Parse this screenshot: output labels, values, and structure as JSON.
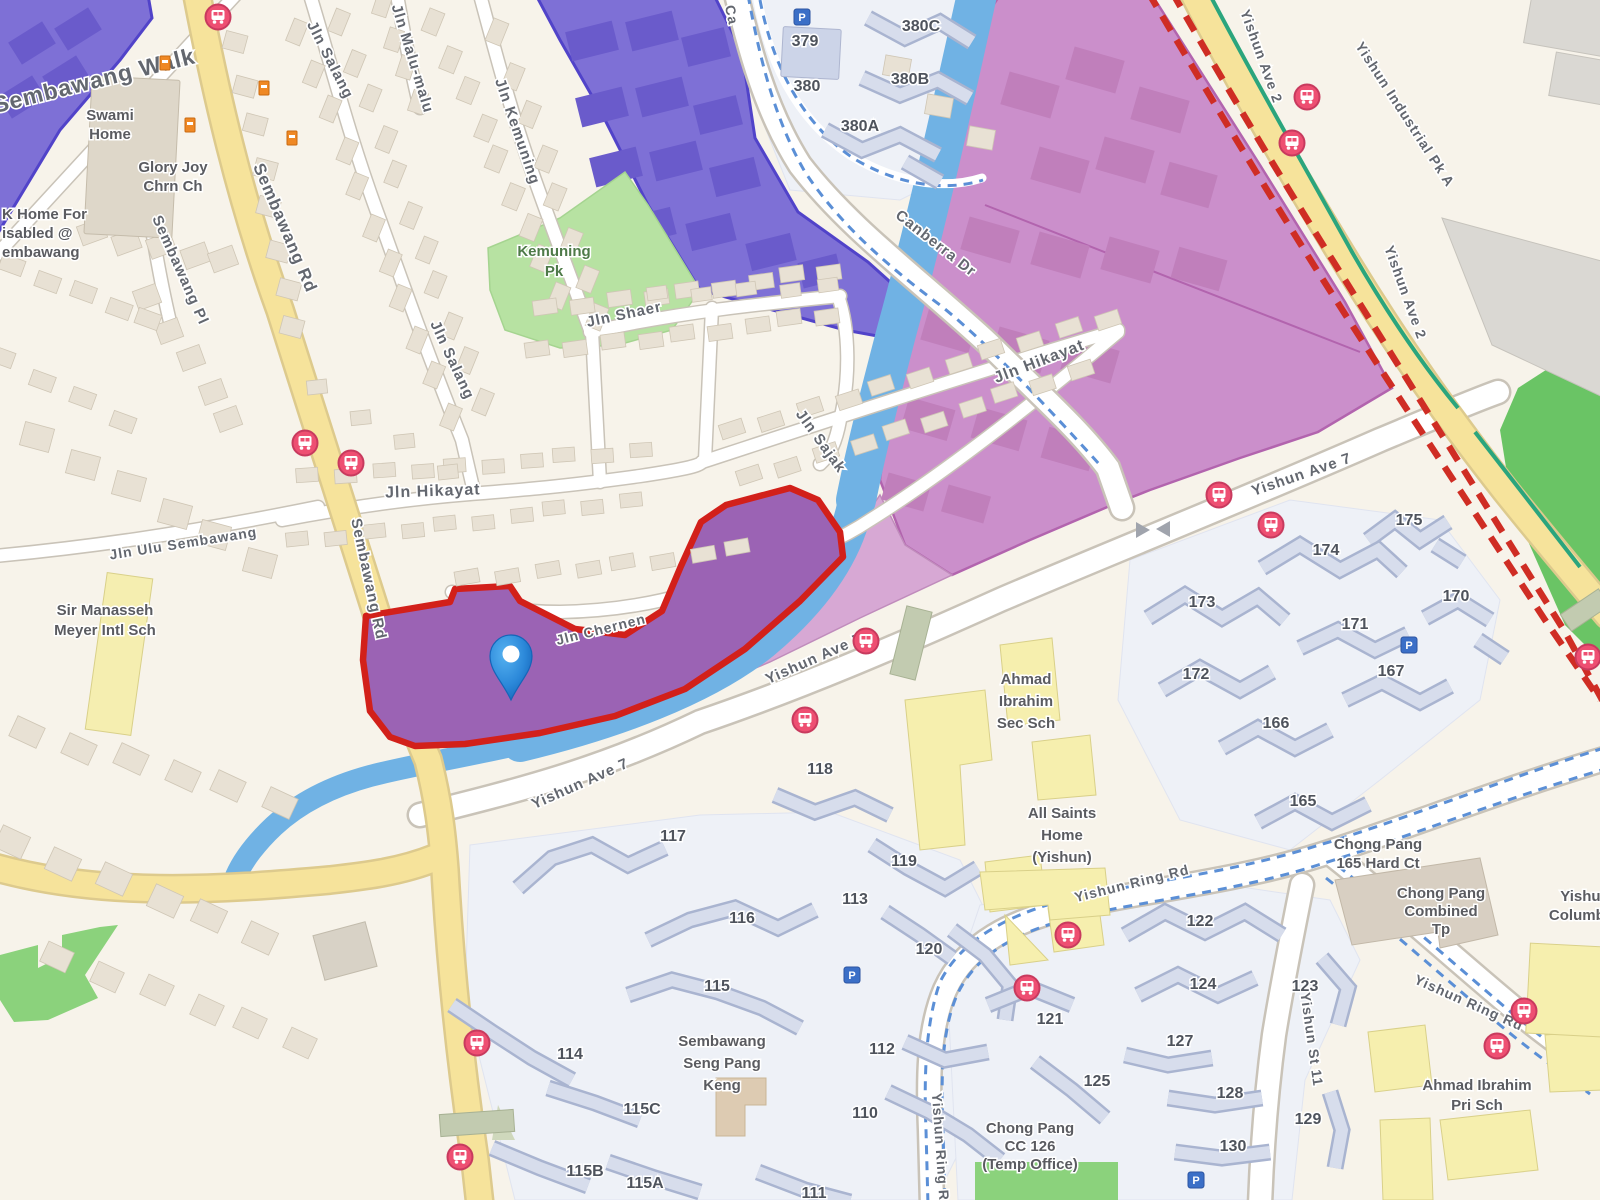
{
  "map_title": "Street map - Sembawang / Yishun area with selected land parcel",
  "colors": {
    "background": "#f7f3ea",
    "parcel_fill": "#9b63b4",
    "parcel_border": "#d2201a",
    "zone_blue_purple": "#7e70d6",
    "zone_blue_purple_border": "#5143c9",
    "zone_magenta": "#cb8fcb",
    "zone_magenta_border": "#b264ae",
    "zone_magenta_light": "#d7a8d4",
    "canal": "#70b2e4",
    "road_major": "#f6e39b",
    "road_minor": "#ffffff",
    "park_green": "#b7e2a2",
    "field_green": "#8bd27c",
    "mrt_dash_red": "#cf2d24",
    "cycleway_blue": "#5b8fd6",
    "connector_teal": "#2ba57d",
    "bus_icon_pink": "#ee4f72",
    "parking_icon_blue": "#3b6fc7",
    "poi_icon_orange": "#ef8824",
    "pin_blue": "#2b88d9"
  },
  "labels": {
    "roads": [
      {
        "id": "sembawang-walk",
        "t": "Sembawang Walk",
        "x": 96,
        "y": 88,
        "r": -14,
        "s": 23,
        "ls": 3
      },
      {
        "id": "sembawang-rd-top",
        "t": "Sembawang Rd",
        "x": 280,
        "y": 230,
        "r": 67,
        "s": 17,
        "ls": 2
      },
      {
        "id": "sembawang-pl",
        "t": "Sembawang Pl",
        "x": 176,
        "y": 272,
        "r": 66,
        "s": 15,
        "ls": 1
      },
      {
        "id": "jln-salang-top",
        "t": "Jln Salang",
        "x": 326,
        "y": 62,
        "r": 63,
        "s": 15,
        "ls": 1
      },
      {
        "id": "jln-malu-malu",
        "t": "Jln Malu-malu",
        "x": 408,
        "y": 60,
        "r": 73,
        "s": 15,
        "ls": 1
      },
      {
        "id": "jln-kemuning",
        "t": "Jln Kemuning",
        "x": 513,
        "y": 133,
        "r": 71,
        "s": 15,
        "ls": 1
      },
      {
        "id": "jln-salang-mid",
        "t": "Jln Salang",
        "x": 448,
        "y": 362,
        "r": 65,
        "s": 15,
        "ls": 1
      },
      {
        "id": "jln-shaer",
        "t": "Jln Shaer",
        "x": 625,
        "y": 319,
        "r": -12,
        "s": 15,
        "ls": 1
      },
      {
        "id": "jln-hikayat-ne",
        "t": "Jln Hikayat",
        "x": 1041,
        "y": 366,
        "r": -21,
        "s": 16,
        "ls": 1
      },
      {
        "id": "jln-hikayat-w",
        "t": "Jln Hikayat",
        "x": 433,
        "y": 496,
        "r": -2,
        "s": 16,
        "ls": 1
      },
      {
        "id": "jln-sajak",
        "t": "Jln Sajak",
        "x": 817,
        "y": 444,
        "r": 54,
        "s": 15,
        "ls": 1
      },
      {
        "id": "jln-chernen",
        "t": "Jln Chernen",
        "x": 602,
        "y": 634,
        "r": -14,
        "s": 14,
        "ls": 1
      },
      {
        "id": "jln-ulu-sembawang",
        "t": "Jln Ulu Sembawang",
        "x": 184,
        "y": 548,
        "r": -9,
        "s": 14,
        "ls": 1
      },
      {
        "id": "sembawang-rd-mid",
        "t": "Sembawang Rd",
        "x": 364,
        "y": 580,
        "r": 78,
        "s": 15,
        "ls": 1
      },
      {
        "id": "canberra-dr-top",
        "t": "Ca",
        "x": 727,
        "y": 16,
        "r": 78,
        "s": 14,
        "ls": 1
      },
      {
        "id": "canberra-dr",
        "t": "Canberra Dr",
        "x": 933,
        "y": 247,
        "r": 38,
        "s": 15,
        "ls": 1
      },
      {
        "id": "yishun-ave-2-n",
        "t": "Yishun Ave 2",
        "x": 1257,
        "y": 58,
        "r": 70,
        "s": 14,
        "ls": 1
      },
      {
        "id": "yishun-ave-2-s",
        "t": "Yishun Ave 2",
        "x": 1401,
        "y": 294,
        "r": 70,
        "s": 14,
        "ls": 1
      },
      {
        "id": "yishun-industrial-pk-a",
        "t": "Yishun Industrial Pk A",
        "x": 1401,
        "y": 117,
        "r": 57,
        "s": 14,
        "ls": 1
      },
      {
        "id": "yishun-ave-7-w",
        "t": "Yishun Ave 7",
        "x": 582,
        "y": 788,
        "r": -24,
        "s": 15,
        "ls": 1
      },
      {
        "id": "yishun-ave-7-m",
        "t": "Yishun Ave 7",
        "x": 816,
        "y": 663,
        "r": -24,
        "s": 15,
        "ls": 1
      },
      {
        "id": "yishun-ave-7-e",
        "t": "Yishun Ave 7",
        "x": 1303,
        "y": 479,
        "r": -19,
        "s": 15,
        "ls": 1
      },
      {
        "id": "yishun-ring-rd-n",
        "t": "Yishun Ring Rd",
        "x": 1133,
        "y": 888,
        "r": -14,
        "s": 14,
        "ls": 1
      },
      {
        "id": "yishun-ring-rd-e",
        "t": "Yishun Ring Rd",
        "x": 1467,
        "y": 1007,
        "r": 24,
        "s": 14,
        "ls": 1
      },
      {
        "id": "yishun-ring-rd-s",
        "t": "Yishun Ring Rd",
        "x": 936,
        "y": 1152,
        "r": 86,
        "s": 14,
        "ls": 1
      },
      {
        "id": "yishun-st-11",
        "t": "Yishun St 11",
        "x": 1307,
        "y": 1040,
        "r": 82,
        "s": 14,
        "ls": 1
      }
    ],
    "places": [
      {
        "id": "swami-home",
        "x": 110,
        "y": 120,
        "lh": 19,
        "lines": [
          "Swami",
          "Home"
        ]
      },
      {
        "id": "glory-joy-chrn-ch",
        "x": 173,
        "y": 172,
        "lh": 19,
        "lines": [
          "Glory Joy",
          "Chrn Ch"
        ]
      },
      {
        "id": "home-for-disabled",
        "x": 2,
        "y": 219,
        "lh": 19,
        "anchor": "start",
        "lines": [
          "K Home For",
          "isabled @",
          "embawang"
        ]
      },
      {
        "id": "kemuning-pk",
        "x": 554,
        "y": 256,
        "lh": 20,
        "cls": "lbl-park",
        "lines": [
          "Kemuning",
          "Pk"
        ]
      },
      {
        "id": "sir-manasseh-meyer-intl-sch",
        "x": 105,
        "y": 615,
        "lh": 20,
        "lines": [
          "Sir Manasseh",
          "Meyer Intl Sch"
        ]
      },
      {
        "id": "ahmad-ibrahim-sec-sch",
        "x": 1026,
        "y": 684,
        "lh": 22,
        "lines": [
          "Ahmad",
          "Ibrahim",
          "Sec Sch"
        ]
      },
      {
        "id": "all-saints-home-yishun",
        "x": 1062,
        "y": 818,
        "lh": 22,
        "lines": [
          "All Saints",
          "Home",
          "(Yishun)"
        ]
      },
      {
        "id": "chong-pang-165-hard-ct",
        "x": 1378,
        "y": 849,
        "lh": 19,
        "lines": [
          "Chong Pang",
          "165 Hard Ct"
        ]
      },
      {
        "id": "chong-pang-combined-tp",
        "x": 1441,
        "y": 898,
        "lh": 18,
        "lines": [
          "Chong Pang",
          "Combined",
          "Tp"
        ]
      },
      {
        "id": "yishun-columbarium-1",
        "x": 1585,
        "y": 901,
        "lh": 19,
        "lines": [
          "Yishun"
        ]
      },
      {
        "id": "yishun-columbarium-2",
        "x": 1581,
        "y": 920,
        "lh": 19,
        "lines": [
          "Columba"
        ]
      },
      {
        "id": "ahmad-ibrahim-pri-sch",
        "x": 1477,
        "y": 1090,
        "lh": 20,
        "lines": [
          "Ahmad Ibrahim",
          "Pri Sch"
        ]
      },
      {
        "id": "sembawang-seng-pang-keng",
        "x": 722,
        "y": 1046,
        "lh": 22,
        "lines": [
          "Sembawang",
          "Seng Pang",
          "Keng"
        ]
      },
      {
        "id": "chong-pang-cc",
        "x": 1030,
        "y": 1133,
        "lh": 18,
        "lines": [
          "Chong Pang",
          "CC 126",
          "(Temp Office)"
        ]
      }
    ],
    "blocks": [
      {
        "t": "379",
        "x": 805,
        "y": 46
      },
      {
        "t": "380",
        "x": 807,
        "y": 91
      },
      {
        "t": "380C",
        "x": 921,
        "y": 31
      },
      {
        "t": "380B",
        "x": 910,
        "y": 84
      },
      {
        "t": "380A",
        "x": 860,
        "y": 131
      },
      {
        "t": "175",
        "x": 1409,
        "y": 525
      },
      {
        "t": "174",
        "x": 1326,
        "y": 555
      },
      {
        "t": "173",
        "x": 1202,
        "y": 607
      },
      {
        "t": "172",
        "x": 1196,
        "y": 679
      },
      {
        "t": "171",
        "x": 1355,
        "y": 629
      },
      {
        "t": "170",
        "x": 1456,
        "y": 601
      },
      {
        "t": "167",
        "x": 1391,
        "y": 676
      },
      {
        "t": "166",
        "x": 1276,
        "y": 728
      },
      {
        "t": "165",
        "x": 1303,
        "y": 806
      },
      {
        "t": "118",
        "x": 820,
        "y": 774
      },
      {
        "t": "119",
        "x": 904,
        "y": 866
      },
      {
        "t": "113",
        "x": 855,
        "y": 904
      },
      {
        "t": "117",
        "x": 673,
        "y": 841
      },
      {
        "t": "116",
        "x": 742,
        "y": 923
      },
      {
        "t": "120",
        "x": 929,
        "y": 954
      },
      {
        "t": "115",
        "x": 717,
        "y": 991
      },
      {
        "t": "114",
        "x": 570,
        "y": 1059
      },
      {
        "t": "112",
        "x": 882,
        "y": 1054
      },
      {
        "t": "115C",
        "x": 642,
        "y": 1114
      },
      {
        "t": "115B",
        "x": 585,
        "y": 1176
      },
      {
        "t": "115A",
        "x": 645,
        "y": 1188
      },
      {
        "t": "110",
        "x": 865,
        "y": 1118
      },
      {
        "t": "111",
        "x": 814,
        "y": 1198
      },
      {
        "t": "122",
        "x": 1200,
        "y": 926
      },
      {
        "t": "124",
        "x": 1203,
        "y": 989
      },
      {
        "t": "123",
        "x": 1305,
        "y": 991
      },
      {
        "t": "121",
        "x": 1050,
        "y": 1024
      },
      {
        "t": "127",
        "x": 1180,
        "y": 1046
      },
      {
        "t": "125",
        "x": 1097,
        "y": 1086
      },
      {
        "t": "128",
        "x": 1230,
        "y": 1098
      },
      {
        "t": "129",
        "x": 1308,
        "y": 1124
      },
      {
        "t": "130",
        "x": 1233,
        "y": 1151
      }
    ]
  },
  "icons": {
    "bus_stops": [
      [
        218,
        17
      ],
      [
        305,
        443
      ],
      [
        351,
        463
      ],
      [
        866,
        641
      ],
      [
        805,
        720
      ],
      [
        1219,
        495
      ],
      [
        1271,
        525
      ],
      [
        1307,
        97
      ],
      [
        1292,
        143
      ],
      [
        477,
        1043
      ],
      [
        460,
        1157
      ],
      [
        1068,
        935
      ],
      [
        1027,
        988
      ],
      [
        1524,
        1011
      ],
      [
        1497,
        1046
      ],
      [
        1588,
        657
      ]
    ],
    "parking": [
      [
        802,
        17
      ],
      [
        852,
        975
      ],
      [
        1409,
        645
      ],
      [
        1196,
        1180
      ]
    ],
    "parking_glyph": "P",
    "poi_orange": [
      [
        165,
        63
      ],
      [
        264,
        88
      ],
      [
        190,
        125
      ],
      [
        292,
        138
      ]
    ],
    "pin": {
      "x": 511,
      "y": 654,
      "tip_y": 700
    }
  }
}
